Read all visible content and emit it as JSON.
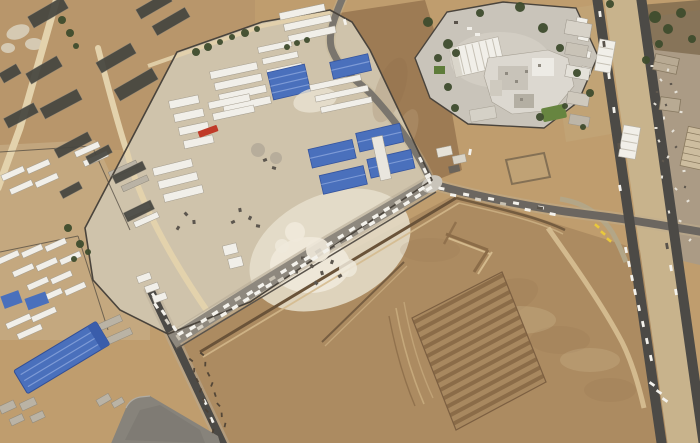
{
  "scene": {
    "type": "satellite-imagery",
    "description": "Aerial satellite view of a desert border-crossing area: a walled logistics compound with blue-roofed warehouses and white container rows, a long queue of white trucks on a diagonal road, a border terminal complex with trees at top right, twin paved corridor roads on the right, greenhouse strips at top left, a large blue warehouse at bottom left, and a large excavated earthwork field at bottom right."
  },
  "palette": {
    "sand_base": "#bf9d6e",
    "sand_dim": "#b3906a",
    "sand_light": "#d9c79e",
    "sand_pale": "#e9e2d1",
    "compound_ground": "#cfc3ab",
    "slope_brown": "#9d7b54",
    "field_brown": "#ac8b61",
    "field_dark": "#8b6c48",
    "field_mid": "#a8885f",
    "rubble_tan": "#ab9b85",
    "road_paved": "#4c4a46",
    "road_mid": "#8e887e",
    "road_sand": "#e3d2ac",
    "roof_blue": "#4a70bc",
    "roof_blue_light": "#7e9bd6",
    "roof_blue_dark": "#35549e",
    "roof_white": "#f1efe9",
    "struct_gray": "#bab3a5",
    "pave_gray": "#c9c4ba",
    "dark_strip": "#45453f",
    "tree_green": "#3e4c2d",
    "grass_green": "#678540",
    "truck_white": "#f4f2ec",
    "truck_gray": "#d7d1c5",
    "truck_red": "#c03a28",
    "veh_yellow": "#e9c83c",
    "wall_dark": "#4a443c",
    "trench_dark": "#6a5339",
    "pad_gray": "#87837b"
  },
  "generated": {
    "truck_queue_lanes": [
      {
        "name": "queue-main",
        "from": [
          182,
          336
        ],
        "to": [
          428,
          187
        ],
        "count": 44,
        "lane_offset": 2.4,
        "size": [
          6.5,
          3.4
        ]
      },
      {
        "name": "queue-bend",
        "from": [
          152,
          297
        ],
        "to": [
          179,
          337
        ],
        "count": 6,
        "lane_offset": 1.5,
        "size": [
          6,
          3
        ]
      },
      {
        "name": "queue-east",
        "from": [
          441,
          191
        ],
        "to": [
          553,
          212
        ],
        "count": 10,
        "lane_offset": 1.8,
        "size": [
          6,
          3
        ]
      },
      {
        "name": "queue-north",
        "from": [
          420,
          160
        ],
        "to": [
          430,
          181
        ],
        "count": 3,
        "lane_offset": 0,
        "size": [
          5.5,
          3
        ]
      }
    ],
    "road_vehicles": [
      [
        600,
        14,
        83,
        "w"
      ],
      [
        604,
        44,
        83,
        "d"
      ],
      [
        609,
        76,
        83,
        "w"
      ],
      [
        614,
        110,
        83,
        "w"
      ],
      [
        619,
        146,
        83,
        "d"
      ],
      [
        626,
        250,
        78,
        "w"
      ],
      [
        629,
        264,
        78,
        "w"
      ],
      [
        632,
        278,
        78,
        "w"
      ],
      [
        635,
        292,
        78,
        "w"
      ],
      [
        639,
        308,
        78,
        "w"
      ],
      [
        643,
        324,
        78,
        "w"
      ],
      [
        647,
        341,
        78,
        "w"
      ],
      [
        651,
        358,
        78,
        "w"
      ],
      [
        667,
        246,
        80,
        "d"
      ],
      [
        671,
        268,
        80,
        "w"
      ],
      [
        676,
        292,
        80,
        "w"
      ],
      [
        652,
        384,
        35,
        "w"
      ],
      [
        659,
        392,
        35,
        "w"
      ],
      [
        665,
        400,
        35,
        "w"
      ],
      [
        540,
        208,
        10,
        "d"
      ],
      [
        470,
        152,
        100,
        "w"
      ],
      [
        620,
        188,
        80,
        "w"
      ],
      [
        345,
        22,
        75,
        "w"
      ],
      [
        205,
        402,
        64,
        "w"
      ],
      [
        212,
        420,
        64,
        "w"
      ]
    ],
    "yellow_vehicles": [
      [
        597,
        226,
        40
      ],
      [
        603,
        233,
        40
      ],
      [
        609,
        240,
        40
      ]
    ],
    "greenhouse_strips": [
      [
        28,
        6,
        40,
        13,
        -30
      ],
      [
        136,
        0,
        36,
        11,
        -30
      ],
      [
        152,
        16,
        38,
        11,
        -30
      ],
      [
        96,
        52,
        40,
        12,
        -30
      ],
      [
        114,
        78,
        44,
        13,
        -30
      ],
      [
        26,
        64,
        36,
        12,
        -30
      ],
      [
        0,
        68,
        20,
        11,
        -30
      ],
      [
        40,
        98,
        42,
        12,
        -28
      ],
      [
        4,
        110,
        34,
        11,
        -28
      ],
      [
        54,
        140,
        38,
        10,
        -28
      ],
      [
        86,
        150,
        26,
        9,
        -28
      ],
      [
        112,
        168,
        34,
        9,
        -26
      ],
      [
        124,
        206,
        30,
        10,
        -26
      ],
      [
        60,
        186,
        22,
        8,
        -28
      ]
    ],
    "trees": [
      [
        62,
        20,
        4
      ],
      [
        70,
        33,
        4
      ],
      [
        76,
        46,
        3
      ],
      [
        196,
        52,
        4
      ],
      [
        208,
        47,
        4
      ],
      [
        220,
        42,
        3
      ],
      [
        232,
        37,
        3
      ],
      [
        245,
        33,
        4
      ],
      [
        257,
        29,
        3
      ],
      [
        287,
        47,
        3
      ],
      [
        297,
        43,
        3
      ],
      [
        307,
        40,
        3
      ],
      [
        448,
        44,
        5
      ],
      [
        456,
        53,
        4
      ],
      [
        428,
        22,
        5
      ],
      [
        438,
        58,
        4
      ],
      [
        448,
        87,
        4
      ],
      [
        455,
        108,
        4
      ],
      [
        480,
        13,
        4
      ],
      [
        520,
        7,
        5
      ],
      [
        543,
        28,
        5
      ],
      [
        560,
        48,
        4
      ],
      [
        577,
        73,
        4
      ],
      [
        590,
        93,
        4
      ],
      [
        540,
        117,
        4
      ],
      [
        565,
        106,
        3
      ],
      [
        655,
        17,
        6
      ],
      [
        668,
        29,
        5
      ],
      [
        681,
        13,
        5
      ],
      [
        692,
        39,
        4
      ],
      [
        659,
        44,
        4
      ],
      [
        646,
        60,
        4
      ],
      [
        610,
        4,
        4
      ],
      [
        68,
        228,
        4
      ],
      [
        80,
        244,
        4
      ],
      [
        74,
        259,
        3
      ],
      [
        88,
        252,
        3
      ],
      [
        583,
        127,
        3
      ]
    ],
    "debris_light": [
      [
        652,
        66
      ],
      [
        661,
        80
      ],
      [
        668,
        70
      ],
      [
        676,
        92
      ],
      [
        655,
        104
      ],
      [
        664,
        118
      ],
      [
        673,
        131
      ],
      [
        681,
        112
      ],
      [
        659,
        141
      ],
      [
        668,
        157
      ],
      [
        684,
        171
      ],
      [
        676,
        189
      ],
      [
        662,
        177
      ],
      [
        688,
        201
      ],
      [
        680,
        221
      ],
      [
        669,
        212
      ],
      [
        690,
        240
      ],
      [
        656,
        128
      ]
    ],
    "debris_dark": [
      [
        657,
        92
      ],
      [
        666,
        105
      ],
      [
        676,
        147
      ],
      [
        663,
        161
      ],
      [
        685,
        187
      ],
      [
        671,
        84
      ]
    ],
    "machinery": [
      [
        303,
        258
      ],
      [
        312,
        266
      ],
      [
        322,
        273
      ],
      [
        332,
        262
      ],
      [
        340,
        276
      ],
      [
        296,
        272
      ],
      [
        316,
        283
      ],
      [
        240,
        210
      ],
      [
        250,
        218
      ],
      [
        233,
        222
      ],
      [
        258,
        226
      ],
      [
        186,
        214
      ],
      [
        194,
        222
      ],
      [
        178,
        228
      ],
      [
        265,
        160
      ],
      [
        274,
        168
      ]
    ],
    "ground_markings": [
      {
        "from": [
          191,
          360
        ],
        "to": [
          213,
          431
        ],
        "count": 8
      },
      {
        "from": [
          202,
          354
        ],
        "to": [
          225,
          425
        ],
        "count": 8
      }
    ]
  },
  "features": {
    "logistics_compound": "walled aid-logistics yard with container rows, tents and blue warehouses",
    "truck_queue": "dense line of white trucks queued along diagonal road",
    "terminal_complex": "border terminal buildings with trees and paved apron",
    "corridor_roads": "twin paved roads with median canopies and vehicles",
    "earthwork_field": "large graded field with berms, trenches and furrowed excavation",
    "greenhouse_strips": "dark greenhouse/solar strips in desert at top left",
    "blue_warehouse": "large blue-roofed warehouse at bottom left",
    "paved_pad": "dark paved pad at bottom left",
    "ground_markings": "illegible dark script-like markings on sand near road"
  }
}
